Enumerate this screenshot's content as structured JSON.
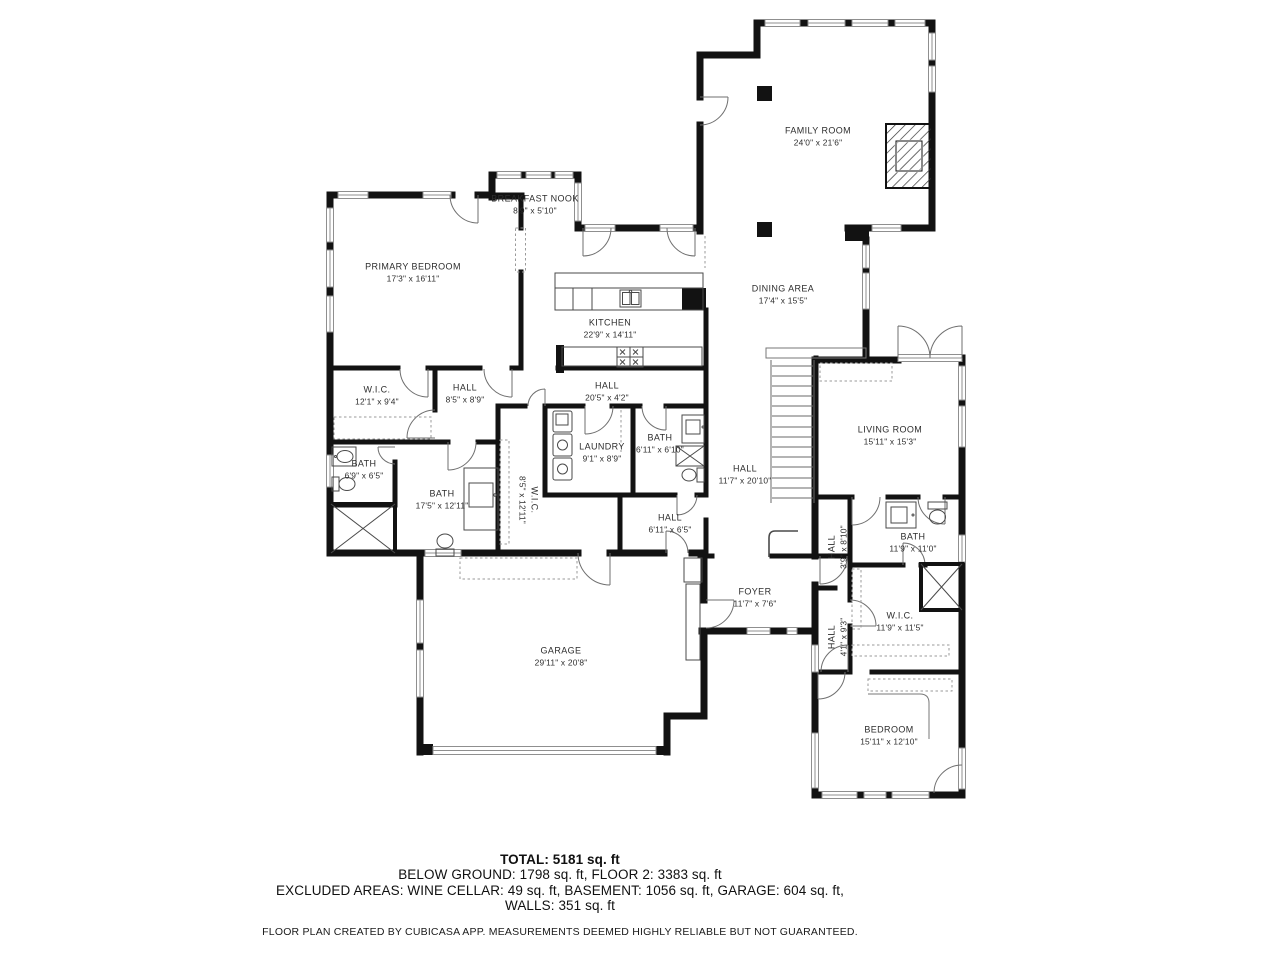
{
  "colors": {
    "wall": "#121212",
    "background": "#ffffff",
    "label": "#2d2d2d",
    "thin_line": "#5a5a5a"
  },
  "rooms": [
    {
      "name": "FAMILY ROOM",
      "dims": "24'0\" x 21'6\"",
      "x": 818,
      "y": 137,
      "rot": 0
    },
    {
      "name": "BREAKFAST NOOK",
      "dims": "8'9\" x 5'10\"",
      "x": 535,
      "y": 205,
      "rot": 0
    },
    {
      "name": "PRIMARY BEDROOM",
      "dims": "17'3\" x 16'11\"",
      "x": 413,
      "y": 273,
      "rot": 0
    },
    {
      "name": "DINING AREA",
      "dims": "17'4\" x 15'5\"",
      "x": 783,
      "y": 295,
      "rot": 0
    },
    {
      "name": "KITCHEN",
      "dims": "22'9\" x 14'11\"",
      "x": 610,
      "y": 329,
      "rot": 0
    },
    {
      "name": "W.I.C.",
      "dims": "12'1\" x 9'4\"",
      "x": 377,
      "y": 396,
      "rot": 0
    },
    {
      "name": "HALL",
      "dims": "8'5\" x 8'9\"",
      "x": 465,
      "y": 394,
      "rot": 0
    },
    {
      "name": "HALL",
      "dims": "20'5\" x 4'2\"",
      "x": 607,
      "y": 392,
      "rot": 0
    },
    {
      "name": "LIVING ROOM",
      "dims": "15'11\" x 15'3\"",
      "x": 890,
      "y": 436,
      "rot": 0
    },
    {
      "name": "BATH",
      "dims": "6'9\" x 6'5\"",
      "x": 364,
      "y": 470,
      "rot": 0
    },
    {
      "name": "LAUNDRY",
      "dims": "9'1\" x 8'9\"",
      "x": 602,
      "y": 453,
      "rot": 0
    },
    {
      "name": "BATH",
      "dims": "6'11\" x 6'10\"",
      "x": 660,
      "y": 444,
      "rot": 0
    },
    {
      "name": "HALL",
      "dims": "11'7\" x 20'10\"",
      "x": 745,
      "y": 475,
      "rot": 0
    },
    {
      "name": "BATH",
      "dims": "17'5\" x 12'11\"",
      "x": 442,
      "y": 500,
      "rot": 0
    },
    {
      "name": "W.I.C.",
      "dims": "8'5\" x 12'11\"",
      "x": 528,
      "y": 500,
      "rot": 90
    },
    {
      "name": "HALL",
      "dims": "6'11\" x 6'5\"",
      "x": 670,
      "y": 524,
      "rot": 0
    },
    {
      "name": "HALL",
      "dims": "3'9\" x 8'10\"",
      "x": 838,
      "y": 547,
      "rot": -90
    },
    {
      "name": "BATH",
      "dims": "11'9\" x 11'0\"",
      "x": 913,
      "y": 543,
      "rot": 0
    },
    {
      "name": "FOYER",
      "dims": "11'7\" x 7'6\"",
      "x": 755,
      "y": 598,
      "rot": 0
    },
    {
      "name": "W.I.C.",
      "dims": "11'9\" x 11'5\"",
      "x": 900,
      "y": 622,
      "rot": 0
    },
    {
      "name": "HALL",
      "dims": "4'1\" x 9'3\"",
      "x": 838,
      "y": 637,
      "rot": -90
    },
    {
      "name": "GARAGE",
      "dims": "29'11\" x 20'8\"",
      "x": 561,
      "y": 657,
      "rot": 0
    },
    {
      "name": "BEDROOM",
      "dims": "15'11\" x 12'10\"",
      "x": 889,
      "y": 736,
      "rot": 0
    }
  ],
  "summary": {
    "total": "TOTAL: 5181 sq. ft",
    "line2": "BELOW GROUND: 1798 sq. ft, FLOOR 2: 3383 sq. ft",
    "line3": "EXCLUDED AREAS: WINE CELLAR: 49 sq. ft, BASEMENT: 1056 sq. ft, GARAGE: 604 sq. ft,",
    "line4": "WALLS: 351 sq. ft",
    "disclaimer": "FLOOR PLAN CREATED BY CUBICASA APP. MEASUREMENTS DEEMED HIGHLY RELIABLE BUT NOT GUARANTEED."
  }
}
